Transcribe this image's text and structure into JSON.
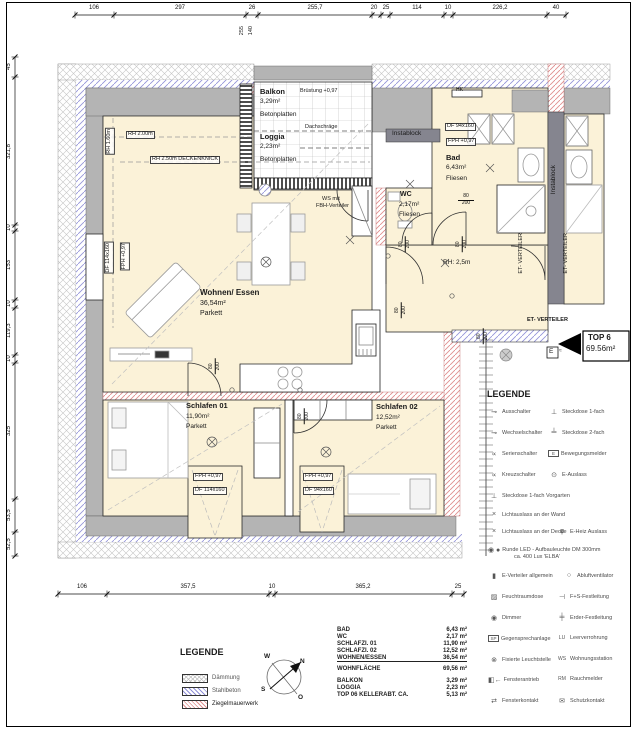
{
  "plan": {
    "rooms": [
      {
        "name": "Balkon",
        "area": "3,29m²",
        "floor": "Betonplatten"
      },
      {
        "name": "Loggia",
        "area": "2,23m²",
        "floor": "Betonplatten"
      },
      {
        "name": "Bad",
        "area": "6,43m²",
        "floor": "Fliesen"
      },
      {
        "name": "WC",
        "area": "2,17m²",
        "floor": "Fliesen"
      },
      {
        "name": "Wohnen/ Essen",
        "area": "36,54m²",
        "floor": "Parkett"
      },
      {
        "name": "Schlafen 01",
        "area": "11,90m²",
        "floor": "Parkett"
      },
      {
        "name": "Schlafen 02",
        "area": "12,52m²",
        "floor": "Parkett"
      }
    ],
    "annotations": {
      "bruestung": "Brüstung +0,97",
      "dachschraege": "Dachschräge",
      "rh200": "RH 2.00m",
      "rh160": "RH 1.60m",
      "deckenknick": "RH 2.50m DECKENKNICK",
      "rh25": "RH: 2,5m",
      "ws_line1": "WS mit",
      "ws_line2": "FBH-Verteiler",
      "instablock": "Instablock",
      "et_verteiler": "ET- VERTEILER",
      "hk": "HK",
      "df94": "DF 94x160",
      "df114": "DF 114x160",
      "fph": "FPH +0,97",
      "door_w": "80",
      "door_h": "200"
    },
    "top6": {
      "label": "TOP 6",
      "area": "69.56m²",
      "e": "E",
      "e_mark": "≈"
    },
    "dims": {
      "top": [
        "106",
        "297",
        "26",
        "255,7",
        "20",
        "25",
        "114",
        "10",
        "226,2",
        "40"
      ],
      "side": [
        "255",
        "140"
      ],
      "left": [
        "45",
        "321,8",
        "10",
        "153",
        "10",
        "119,3",
        "10",
        "325",
        "53,5",
        "52,5"
      ],
      "bottom": [
        "106",
        "357,5",
        "10",
        "365,2",
        "25"
      ]
    }
  },
  "legend_electrical": {
    "title": "LEGENDE",
    "items": [
      {
        "icon": "⊸",
        "label": "Ausschalter"
      },
      {
        "icon": "⊥",
        "label": "Steckdose 1-fach"
      },
      {
        "icon": "⊸",
        "label": "Wechselschalter"
      },
      {
        "icon": "╧",
        "label": "Steckdose 2-fach"
      },
      {
        "icon": "∝",
        "label": "Serienschalter"
      },
      {
        "icon": "E",
        "label": "Bewegungsmelder"
      },
      {
        "icon": "∝",
        "label": "Kreuzschalter"
      },
      {
        "icon": "⊙",
        "label": "E-Auslass"
      },
      {
        "icon": "⊥",
        "label": "Steckdose 1-fach Vorgarten"
      },
      {
        "icon": "×",
        "label": "Lichtauslass an der Wand"
      },
      {
        "icon": "×",
        "label": "Lichtauslass an der Decke"
      },
      {
        "icon": "φ",
        "label": "E-Heiz Auslass"
      },
      {
        "icon": "◉ ●",
        "label": "Runde LED - Aufbauleuchte DM 300mm"
      },
      {
        "icon": "",
        "label": "ca. 400 Lux 'ELBA'"
      },
      {
        "icon": "▮",
        "label": "E-Verteiler allgemein"
      },
      {
        "icon": "○",
        "label": "Abluftventilator"
      },
      {
        "icon": "▨",
        "label": "Feuchtraumdose"
      },
      {
        "icon": "⊣",
        "label": "F+S-Festleitung"
      },
      {
        "icon": "◉",
        "label": "Dimmer"
      },
      {
        "icon": "╪",
        "label": "Erder-Festleitung"
      },
      {
        "icon": "SP",
        "label": "Gegensprechanlage"
      },
      {
        "icon": "LU",
        "label": "Leerverrohrung"
      },
      {
        "icon": "⊗",
        "label": "Fixierte Leuchtstelle"
      },
      {
        "icon": "WS",
        "label": "Wohnungsstation"
      },
      {
        "icon": "◧←",
        "label": "Fensterantrieb"
      },
      {
        "icon": "RM",
        "label": "Rauchmelder"
      },
      {
        "icon": "⇄",
        "label": "Fensterkontakt"
      },
      {
        "icon": "✉",
        "label": "Schutzkontakt"
      }
    ]
  },
  "legend_materials": {
    "title": "LEGENDE",
    "items": [
      {
        "label": "Dämmung"
      },
      {
        "label": "Stahlbeton"
      },
      {
        "label": "Ziegelmauerwerk"
      }
    ]
  },
  "compass": {
    "w": "W",
    "n": "N",
    "s": "S",
    "o": "O"
  },
  "area_table": {
    "rows": [
      {
        "label": "BAD",
        "value": "6,43 m²"
      },
      {
        "label": "WC",
        "value": "2,17 m²"
      },
      {
        "label": "SCHLAFZI. 01",
        "value": "11,90 m²"
      },
      {
        "label": "SCHLAFZI. 02",
        "value": "12,52 m²"
      },
      {
        "label": "WOHNEN/ESSEN",
        "value": "36,54 m²"
      },
      {
        "label": "WOHNFLÄCHE",
        "value": "69,56 m²"
      },
      {
        "label": "BALKON",
        "value": "3,29 m²"
      },
      {
        "label": "LOGGIA",
        "value": "2,23 m²"
      },
      {
        "label": "TOP 06 KELLERABT. CA.",
        "value": "5,13 m²"
      }
    ]
  }
}
